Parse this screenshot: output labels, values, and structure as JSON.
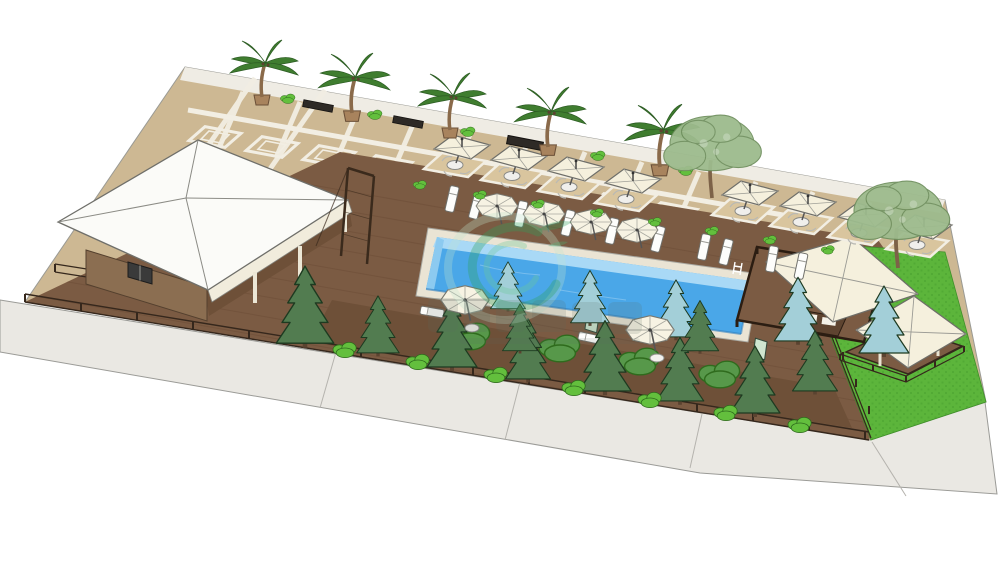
{
  "scene": {
    "title": "3D landscape visualization — poolside terrace site plan",
    "description": "Isometric sketch-style 3D render of a rectangular resort plot with a pavilion, long swimming pool, wooden sun deck, umbrella dining terrace, palm walk, conifer garden strip, lawn with gazebos and a perimeter sidewalk",
    "watermark": {
      "logo": "green-leaf-swirl",
      "text_legible": false
    }
  },
  "colors": {
    "background": "#ffffff",
    "paving_tan": "#cdb893",
    "paving_grid_white": "#f2eee3",
    "deck_brown": "#7b5b43",
    "garden_soil": "#6e5038",
    "grass_green": "#5cb53b",
    "pool_water": "#4aa7e8",
    "pool_wall": "#a9d9f6",
    "pool_coping": "#eae4d4",
    "sidewalk_gray": "#eae8e3",
    "roof_white": "#fbfbf8",
    "canopy_cream": "#f5f0dd",
    "pine_green": "#527c50",
    "spruce_blue": "#a3cfd8",
    "bush_green": "#63bf3d",
    "palm_green": "#3f7d2f",
    "tree_sage": "#9dbb8d",
    "wood_dark": "#35271c"
  },
  "inventory": {
    "swimming_pool": 1,
    "pavilion": 1,
    "pergola_cabana": 1,
    "lawn_gazebo": 1,
    "palm_trees": 5,
    "shade_trees": 2,
    "pine_trees": 10,
    "blue_spruces": 5,
    "dining_umbrellas": 8,
    "pool_umbrellas": 4,
    "garden_umbrellas": 2,
    "sun_loungers": 12,
    "benches": 3
  }
}
